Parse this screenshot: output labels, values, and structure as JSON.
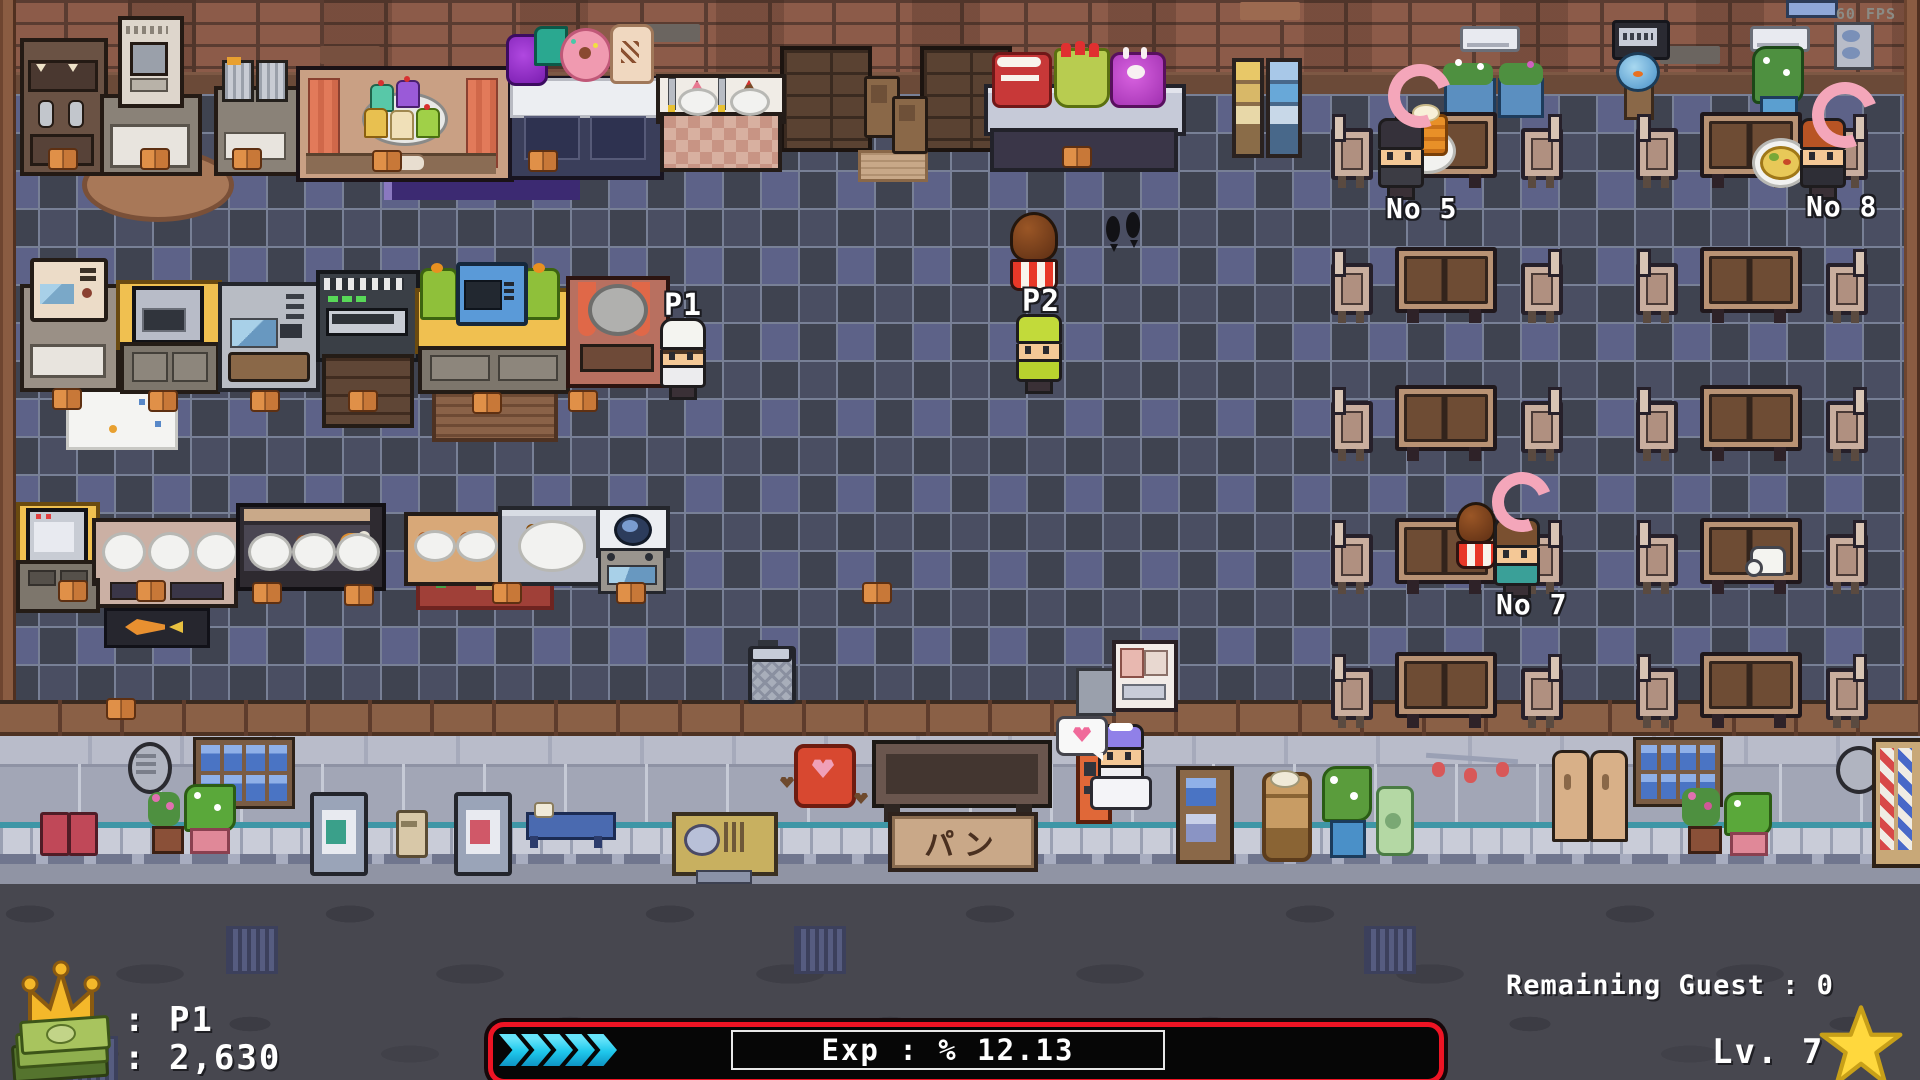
{
  "window": {
    "fps_label": "60 FPS"
  },
  "players": {
    "p1": "P1",
    "p2": "P2"
  },
  "guests": {
    "no5": "No 5",
    "no7": "No 7",
    "no8": "No 8"
  },
  "street": {
    "shop_sign": "パン"
  },
  "hud": {
    "owner_label": ": P1",
    "money_label": ": 2,630",
    "money_value": 2630,
    "exp_label": "Exp : % 12.13",
    "exp_percent": 12.13,
    "remaining_guest_label": "Remaining Guest : 0",
    "remaining_guest_value": 0,
    "level_label": "Lv. 7",
    "level_value": 7
  },
  "icons": {
    "crown": "crown-icon",
    "money": "money-icon",
    "star": "star-icon",
    "exp_arrows": "exp-progress-chevrons",
    "guest_ring": "guest-attention-crescent"
  },
  "colors": {
    "exp_border": "#ee1424",
    "exp_fill": "#1fc8ec",
    "hud_text": "#ffffff",
    "crown": "#f4b82a",
    "star": "#ffd83d",
    "crescent": "#f4a6ba",
    "floor_dark": "#3f4350",
    "floor_blue": "#5d6288",
    "brick": "#8c5b49"
  }
}
